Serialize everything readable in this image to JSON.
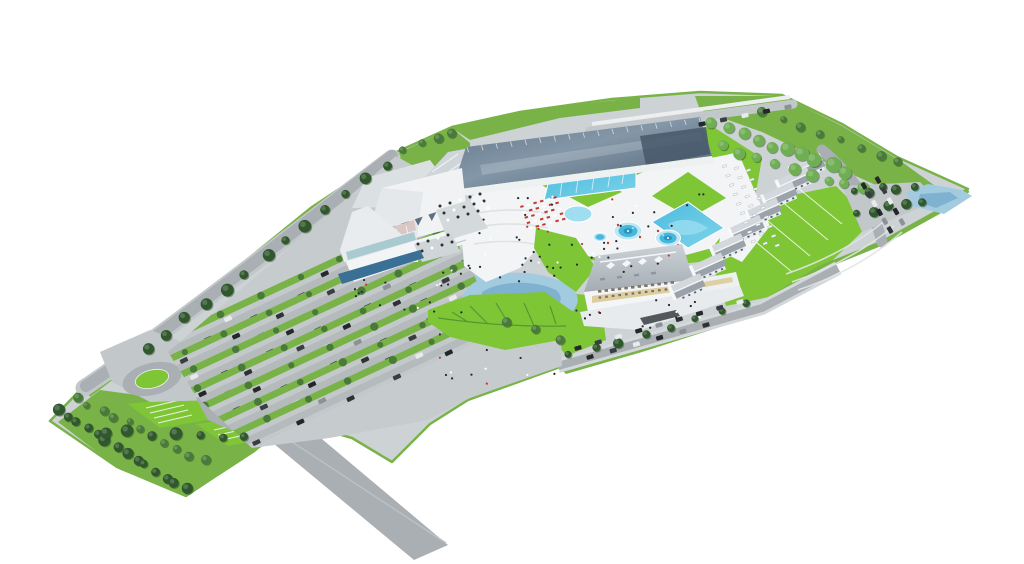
{
  "meta": {
    "description": "Aerial 3D architectural rendering of a thermal spa / water-park resort: glass-roofed aqua hall, outdoor pool terraces, hotel, villa row, central pond with leaf-shaped lawn, roundabout and large tree-lined parking lots on a wedge-shaped site",
    "background": "#ffffff"
  },
  "palette": {
    "background": "#ffffff",
    "paving": "#cdd2d5",
    "plaza": "#f2f4f6",
    "road": "#a9afb3",
    "road_light": "#c2c7ca",
    "lawn_bright": "#7fc637",
    "lawn_mid": "#79b348",
    "lawn_pale": "#a5d36b",
    "tree_dark": "#30582c",
    "tree_mid": "#4a7a3a",
    "tree_light": "#6fae52",
    "pool": "#45b8dc",
    "pool_light": "#9fdef0",
    "pool_deep": "#2b93bd",
    "pond": "#a3cbe0",
    "pond_deep": "#7fb2d0",
    "water_dark": "#3a6f96",
    "hall_roof": "#5d7183",
    "hall_roof_dark": "#47586a",
    "roof_light": "#d3d8dc",
    "roof_dark": "#9aa3ab",
    "white": "#f6f8f9",
    "facade_warm": "#d9ca97",
    "detail_dark": "#24282b",
    "red": "#c13a30"
  },
  "parking": {
    "origin": [
      164,
      348
    ],
    "angle": -25,
    "rows": 7,
    "gap": 19,
    "len": 420,
    "cars_per_row": 15,
    "car_colors": [
      "#26292c",
      "#3a3e42",
      "#e8eaeb",
      "#23262a",
      "#8b9196",
      "#2e3236"
    ],
    "tree_gap": 46
  },
  "tree_lines": [
    {
      "from": [
        58,
        412
      ],
      "to": [
        186,
        490
      ],
      "count": 14,
      "r": 5,
      "color": "tree_dark"
    },
    {
      "from": [
        76,
        398
      ],
      "to": [
        204,
        462
      ],
      "count": 11,
      "r": 4,
      "color": "tree_mid"
    },
    {
      "from": [
        104,
        432
      ],
      "to": [
        246,
        436
      ],
      "count": 7,
      "r": 5,
      "color": "tree_dark"
    },
    {
      "from": [
        146,
        350
      ],
      "to": [
        386,
        164
      ],
      "count": 13,
      "r": 5,
      "color": "tree_dark"
    },
    {
      "from": [
        712,
        124
      ],
      "to": [
        846,
        172
      ],
      "count": 10,
      "r": 6,
      "color": "tree_light"
    },
    {
      "from": [
        724,
        146
      ],
      "to": [
        864,
        190
      ],
      "count": 9,
      "r": 5,
      "color": "tree_light"
    },
    {
      "from": [
        762,
        110
      ],
      "to": [
        900,
        162
      ],
      "count": 8,
      "r": 4,
      "color": "tree_mid"
    },
    {
      "from": [
        852,
        192
      ],
      "to": [
        912,
        186
      ],
      "count": 5,
      "r": 4,
      "color": "tree_dark"
    },
    {
      "from": [
        858,
        214
      ],
      "to": [
        920,
        202
      ],
      "count": 5,
      "r": 4,
      "color": "tree_dark"
    },
    {
      "from": [
        568,
        356
      ],
      "to": [
        748,
        304
      ],
      "count": 8,
      "r": 4,
      "color": "tree_dark"
    },
    {
      "from": [
        404,
        152
      ],
      "to": [
        452,
        132
      ],
      "count": 4,
      "r": 4,
      "color": "tree_mid"
    },
    {
      "from": [
        508,
        320
      ],
      "to": [
        560,
        338
      ],
      "count": 3,
      "r": 4,
      "color": "tree_mid"
    }
  ],
  "car_lines": [
    {
      "from": [
        578,
        348
      ],
      "to": [
        740,
        302
      ],
      "count": 9,
      "angle": -16
    },
    {
      "from": [
        590,
        357
      ],
      "to": [
        706,
        325
      ],
      "count": 6,
      "angle": -16
    },
    {
      "from": [
        702,
        124
      ],
      "to": [
        788,
        107
      ],
      "count": 5,
      "angle": -12
    },
    {
      "from": [
        864,
        186
      ],
      "to": [
        890,
        230
      ],
      "count": 6,
      "angle": 60
    },
    {
      "from": [
        878,
        180
      ],
      "to": [
        902,
        222
      ],
      "count": 5,
      "angle": 60
    }
  ],
  "people": {
    "regions": [
      [
        466,
        196,
        96,
        86,
        30
      ],
      [
        560,
        238,
        120,
        38,
        16
      ],
      [
        352,
        258,
        120,
        56,
        22
      ],
      [
        576,
        300,
        130,
        36,
        14
      ],
      [
        430,
        330,
        140,
        56,
        12
      ],
      [
        610,
        180,
        110,
        50,
        12
      ]
    ]
  },
  "loungers_red": {
    "at": [
      520,
      206
    ],
    "cols": 6,
    "rows": 5,
    "dx": [
      6.6,
      -1.8
    ],
    "dy": [
      2.2,
      5.4
    ]
  },
  "loungers_promenade": {
    "at": [
      722,
      166
    ],
    "cols": 3,
    "rows": 9,
    "dx": [
      12,
      2
    ],
    "dy": [
      3.6,
      9.4
    ]
  },
  "terrace_tables": [
    {
      "at": [
        440,
        206
      ],
      "cols": 5,
      "rows": 3,
      "dx": [
        10,
        -3
      ],
      "dy": [
        4,
        7
      ]
    },
    {
      "at": [
        418,
        244
      ],
      "cols": 4,
      "rows": 2,
      "dx": [
        10,
        -3
      ],
      "dy": [
        4,
        7
      ]
    }
  ],
  "villas": {
    "count": 8,
    "from": [
      808,
      166
    ],
    "ctrl": [
      764,
      212
    ],
    "to": [
      688,
      286
    ]
  },
  "sawtooth": {
    "n": 5,
    "from": [
      374,
      233
    ],
    "step": [
      13.6,
      -4.6
    ]
  },
  "mullions": {
    "n": 17,
    "from": [
      467,
      147
    ],
    "to": [
      699,
      118
    ]
  },
  "hotel_windows": {
    "n": 12,
    "from": [
      598,
      290
    ],
    "step": [
      6.6,
      -0.8
    ]
  },
  "counts": {
    "outdoor_rect_pools": 2,
    "circular_pools": 3,
    "villa_blocks": 8,
    "parking_rows": 7
  }
}
